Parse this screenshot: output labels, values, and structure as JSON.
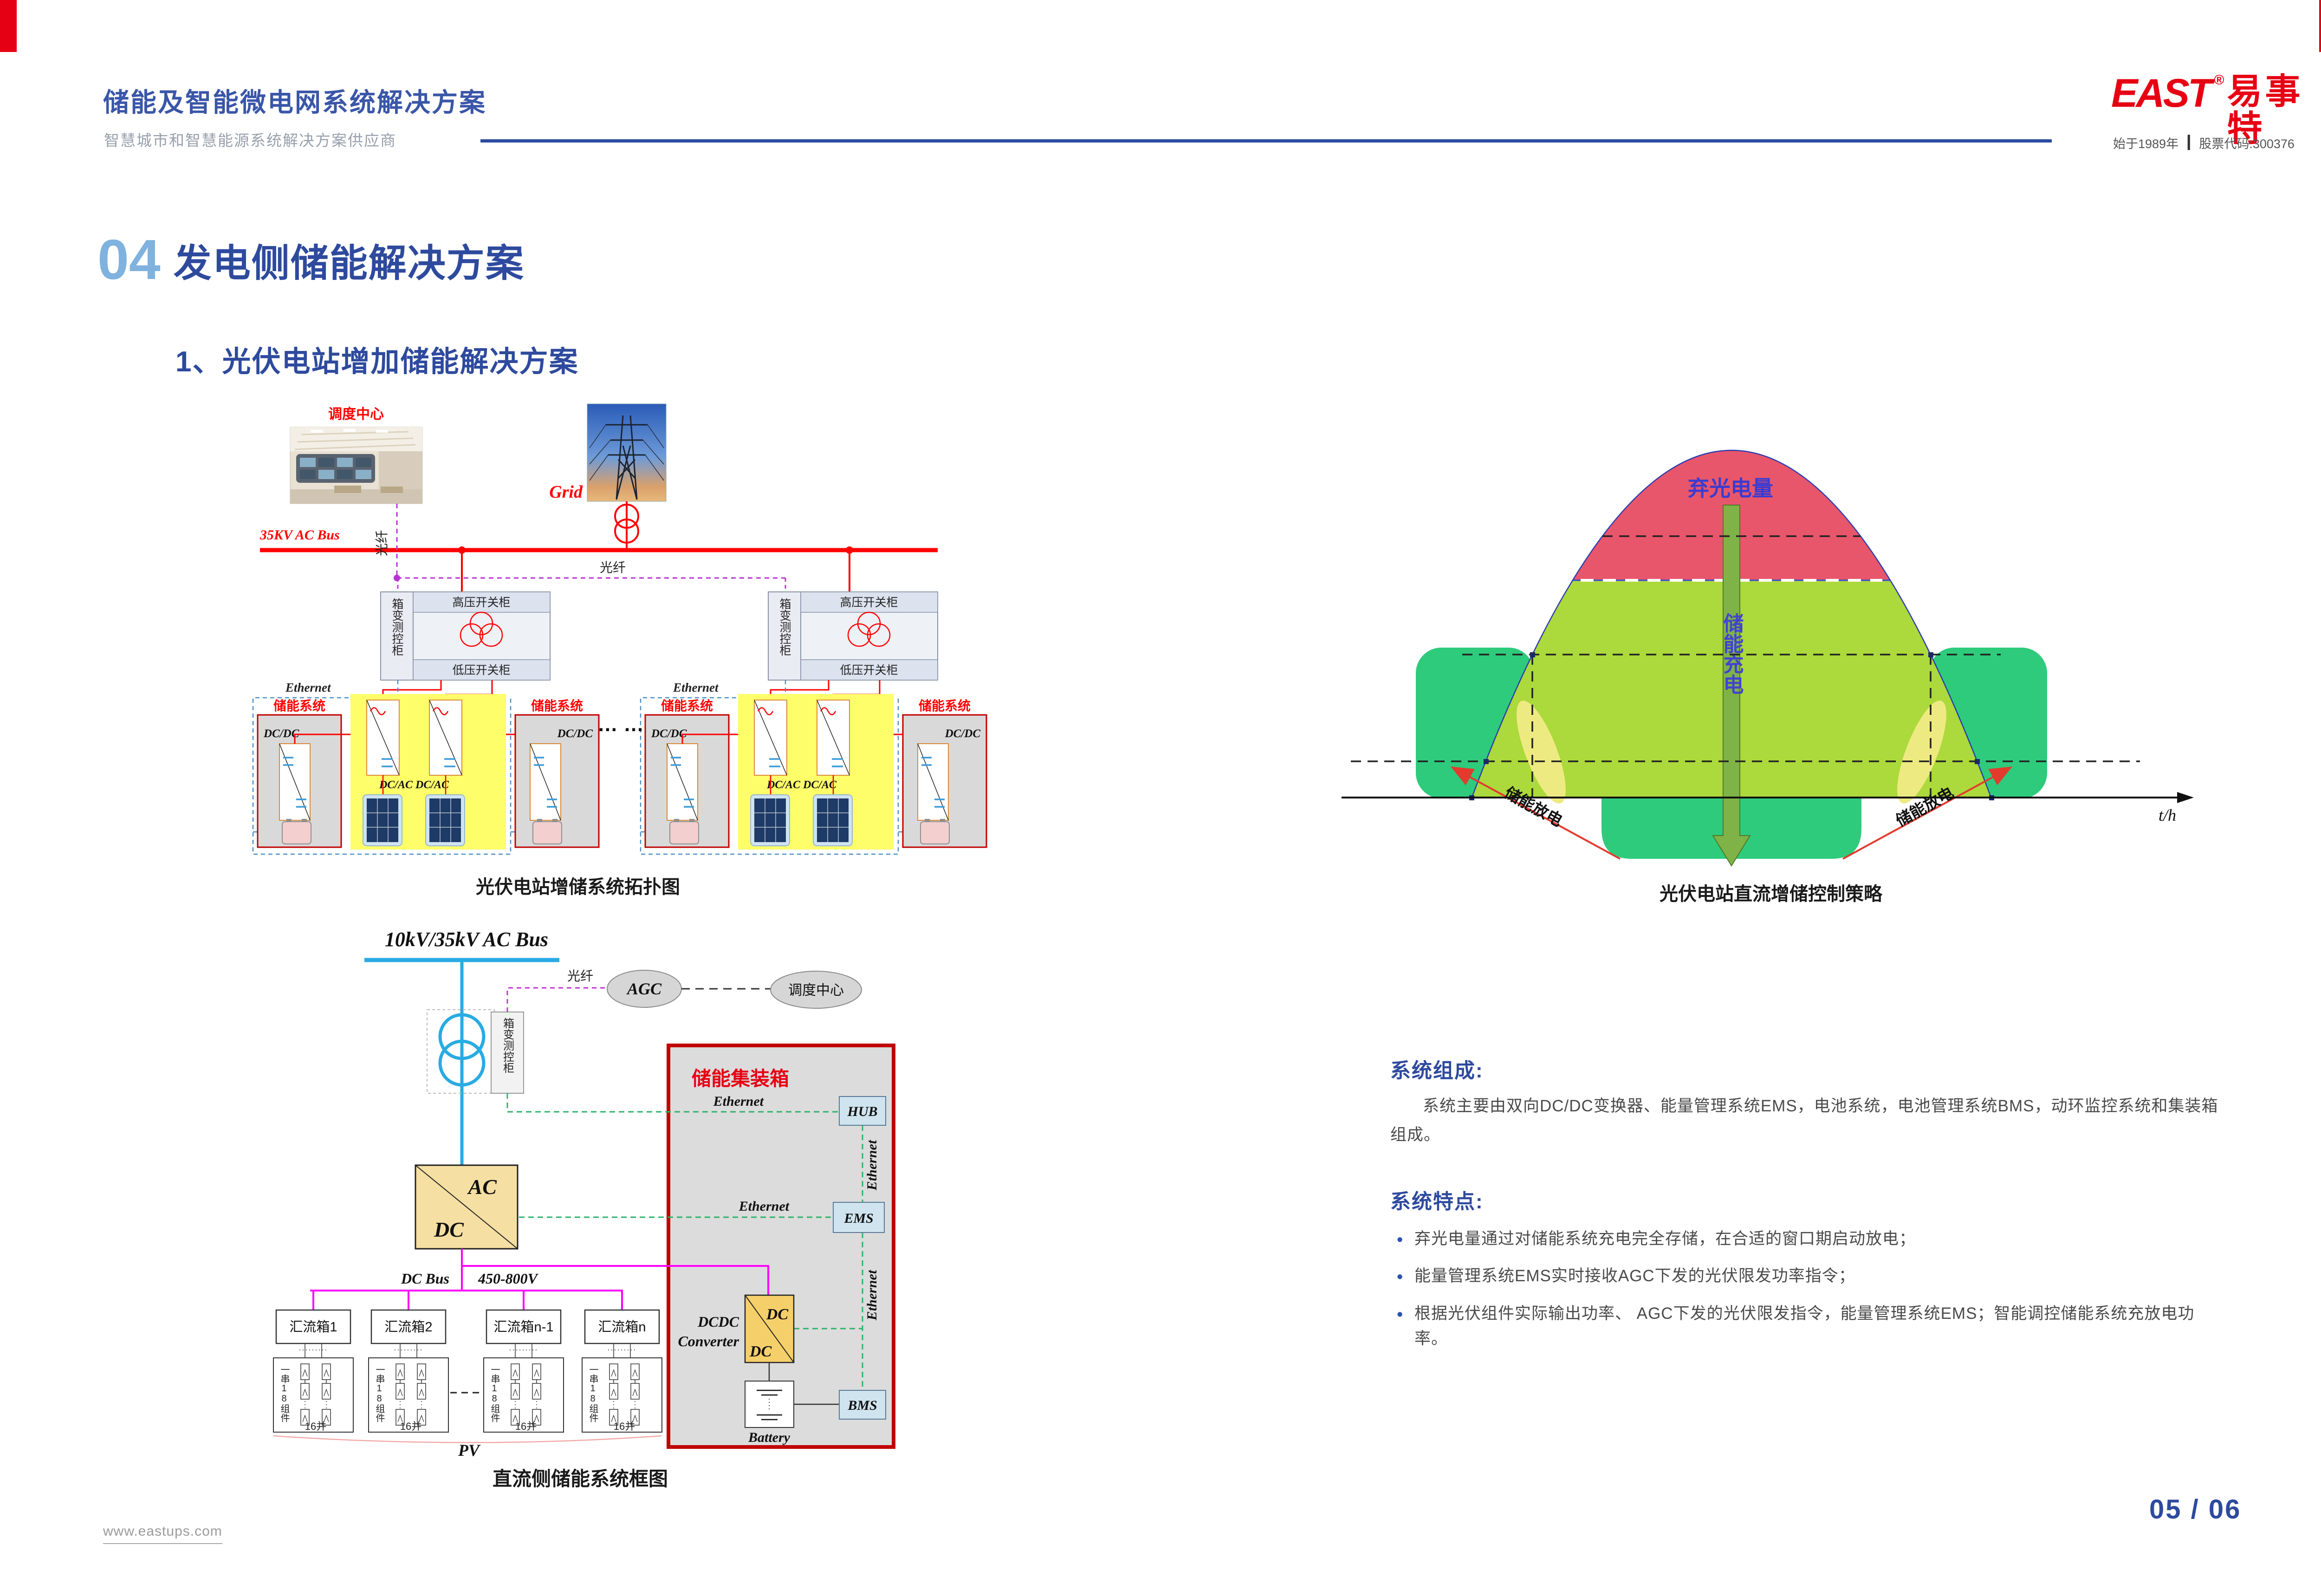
{
  "header": {
    "title": "储能及智能微电网系统解决方案",
    "subtitle": "智慧城市和智慧能源系统解决方案供应商",
    "logo": {
      "east": "EAST",
      "reg": "®",
      "cn": "易事特",
      "since": "始于1989年",
      "divider": "┃",
      "stock": "股票代码:300376"
    }
  },
  "section": {
    "number": "04",
    "title": "发电侧储能解决方案",
    "subsection": "1、光伏电站增加储能解决方案"
  },
  "topology": {
    "caption": "光伏电站增储系统拓扑图",
    "dispatch_center": "调度中心",
    "grid_label": "Grid",
    "ac_bus": "35KV AC Bus",
    "fiber": "光纤",
    "cabinet": "箱变测控柜",
    "hv_cabinet": "高压开关柜",
    "lv_cabinet": "低压开关柜",
    "ethernet": "Ethernet",
    "ess_label": "储能系统",
    "dcdc_label": "DC/DC",
    "dcac_label": "DC/AC DC/AC",
    "ellipsis": "… …"
  },
  "dc_diagram": {
    "caption": "直流侧储能系统框图",
    "ac_bus": "10kV/35kV AC Bus",
    "fiber": "光纤",
    "agc": "AGC",
    "dispatch_center": "调度中心",
    "cabinet": "箱变测控柜",
    "container_title": "储能集装箱",
    "ethernet": "Ethernet",
    "hub": "HUB",
    "ems": "EMS",
    "bms": "BMS",
    "ac": "AC",
    "dc": "DC",
    "dc_bus": "DC Bus",
    "dc_bus_voltage": "450-800V",
    "dcdc_l1": "DCDC",
    "dcdc_l2": "Converter",
    "combiners": [
      "汇流箱1",
      "汇流箱2",
      "汇流箱n-1",
      "汇流箱n"
    ],
    "string_label": "一串18组件",
    "parallel_label": "16并",
    "pv_label": "PV",
    "battery_label": "Battery"
  },
  "strategy": {
    "caption": "光伏电站直流增储控制策略",
    "curtailed": "弃光电量",
    "charge": "储能充电",
    "discharge": "储能放电",
    "x_axis": "t/h"
  },
  "chart_data": {
    "type": "area",
    "title": "光伏电站直流增储控制策略",
    "xlabel": "t/h",
    "ylabel": "",
    "series": [
      {
        "name": "光伏出力日曲线",
        "x": [
          5,
          7,
          9,
          11,
          13,
          15,
          17,
          19,
          21
        ],
        "values": [
          0,
          0.28,
          0.62,
          0.9,
          1.0,
          0.9,
          0.62,
          0.28,
          0
        ]
      }
    ],
    "limit_level": 0.63,
    "annotations": [
      {
        "label": "弃光电量",
        "region": "bell area above limit line",
        "color": "#e8566b"
      },
      {
        "label": "储能充电",
        "region": "center downward arrow: curtailed energy charged into storage",
        "color": "#7fb347"
      },
      {
        "label": "储能放电",
        "region": "morning / evening shoulder areas discharged from storage",
        "color": "#2ecb7c"
      }
    ],
    "legend_position": "none",
    "grid": false
  },
  "system": {
    "composition_title": "系统组成:",
    "composition_text": "系统主要由双向DC/DC变换器、能量管理系统EMS，电池系统，电池管理系统BMS，动环监控系统和集装箱组成。",
    "features_title": "系统特点:",
    "bullets": [
      "弃光电量通过对储能系统充电完全存储，在合适的窗口期启动放电；",
      "能量管理系统EMS实时接收AGC下发的光伏限发功率指令；",
      "根据光伏组件实际输出功率、 AGC下发的光伏限发指令，能量管理系统EMS；智能调控储能系统充放电功率。"
    ]
  },
  "footer": {
    "website": "www.eastups.com",
    "page": "05 / 06"
  },
  "colors": {
    "brand_blue": "#2e4a9e",
    "light_blue": "#7fb2de",
    "brand_red": "#e60013",
    "bus_red": "#ff0000",
    "bus_cyan": "#29abe2",
    "dc_magenta": "#ff00ff",
    "ethernet_green": "#2db36a",
    "ethernet_blue": "#4a90c8",
    "fiber_purple": "#b832d6",
    "curtail_red": "#e8566b",
    "pv_green": "#acd93b",
    "storage_green": "#2ecb7c"
  }
}
